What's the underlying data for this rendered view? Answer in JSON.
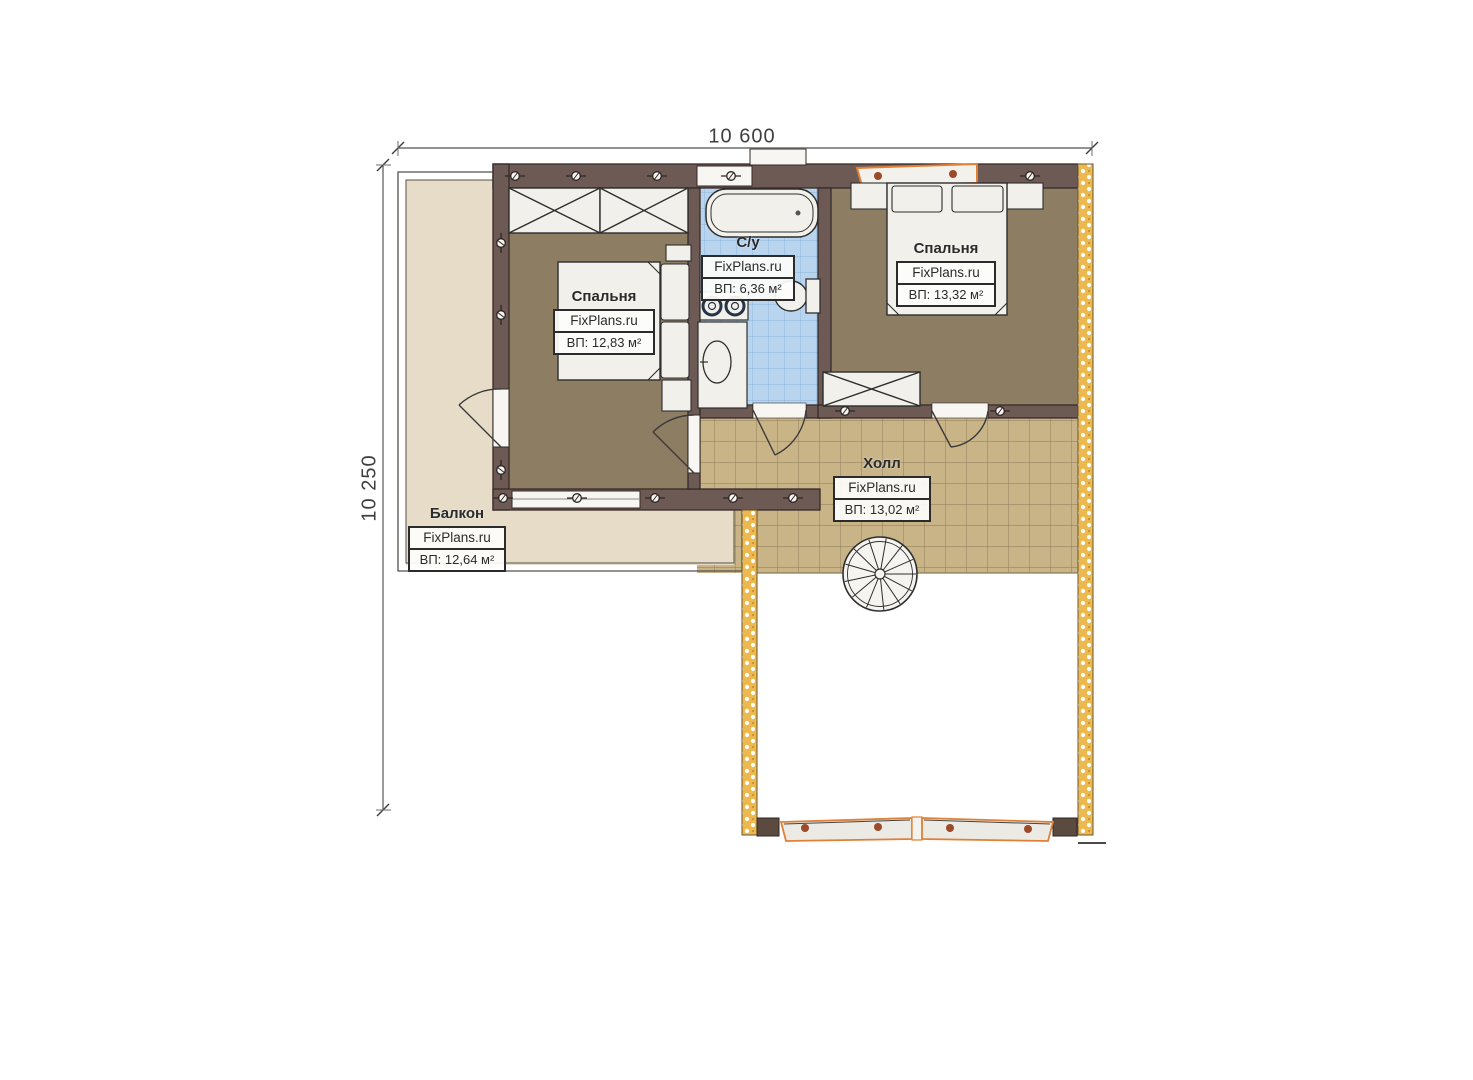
{
  "dimensions": {
    "width_label": "10 600",
    "height_label": "10 250"
  },
  "rooms": {
    "bedroom_left": {
      "name": "Спальня",
      "brand": "FixPlans.ru",
      "area": "ВП: 12,83 м²"
    },
    "bathroom": {
      "name": "С/у",
      "brand": "FixPlans.ru",
      "area": "ВП: 6,36 м²"
    },
    "bedroom_right": {
      "name": "Спальня",
      "brand": "FixPlans.ru",
      "area": "ВП: 13,32 м²"
    },
    "hall": {
      "name": "Холл",
      "brand": "FixPlans.ru",
      "area": "ВП: 13,02 м²"
    },
    "balcony": {
      "name": "Балкон",
      "brand": "FixPlans.ru",
      "area": "ВП: 12,64 м²"
    }
  },
  "colors": {
    "wall": "#6d5a55",
    "bedroom_floor": "#8d7d62",
    "hall_tile": "#c9b487",
    "bath_tile": "#b9d4ef",
    "balcony_floor": "#e6dcc8",
    "insulated_wall": "#edb94f",
    "window_frame_orange": "#e08035",
    "furniture": "#f1f0eb"
  }
}
